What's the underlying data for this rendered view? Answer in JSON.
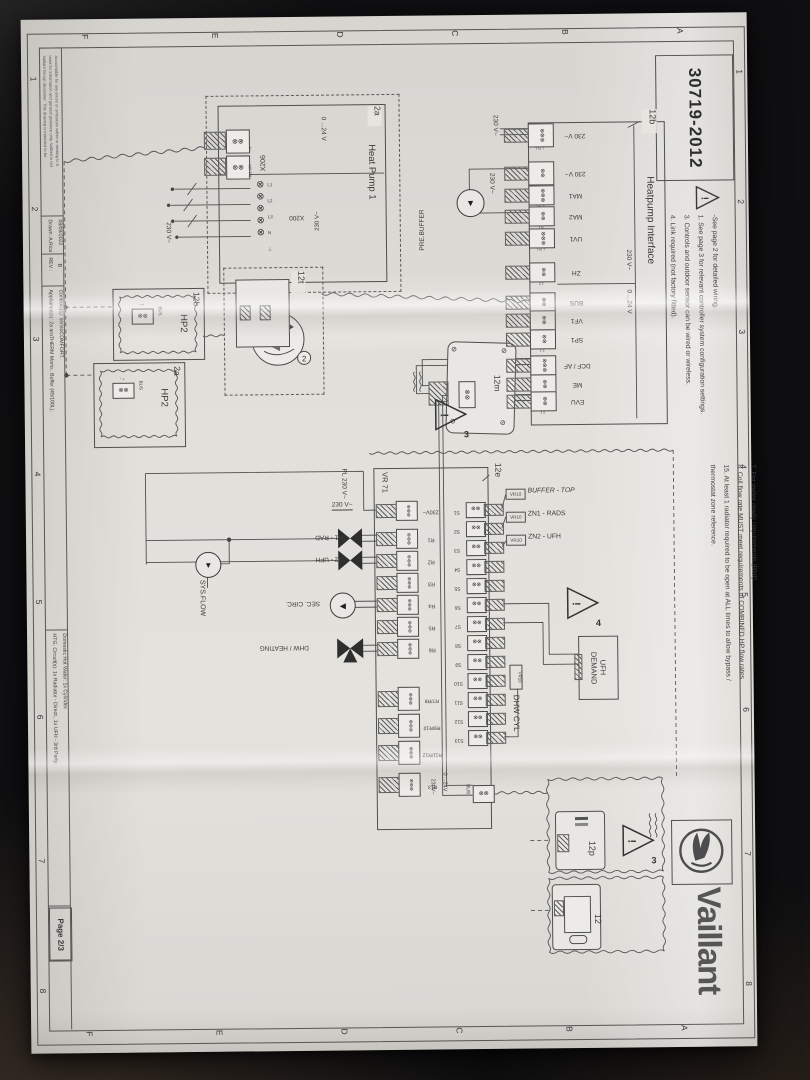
{
  "window": {
    "drawing_number": "30719-2012",
    "page": "Page 2/3",
    "brand": "Vaillant"
  },
  "zones": {
    "letters": [
      "A",
      "B",
      "C",
      "D",
      "E",
      "F"
    ],
    "numbers": [
      "1",
      "2",
      "3",
      "4",
      "5",
      "6",
      "7",
      "8"
    ]
  },
  "notes_top_left": [
    "-See page 2 for detailed wiring.",
    "1. See page 3 for relevant controller system configuration settings.",
    "3. Controls and outdoor sensor can be wired or wireless.",
    "4. Link required (not factory fitted)."
  ],
  "notes_top_right": [
    "7. For meter ready requirements (RHI).",
    "8. Coil flow rate MUST meet requirements of COMBINED HP flow rates.",
    "15. At least 1 radiator required to be open at ALL times to allow bypass /",
    "thermostat zone reference."
  ],
  "heatpump_interface": {
    "callout": "12b",
    "title": "Heatpump Interface",
    "hv_range": "230 V~",
    "lv_range": "0 ...24 V",
    "supply_labels": [
      "230 V~",
      "230 V~"
    ],
    "prebuffer": "PRE.BUFFER",
    "terminals": [
      {
        "label": "230 V~",
        "pins": "⊥ N L"
      },
      {
        "label": "230 V~",
        "pins": "N L"
      },
      {
        "label": "MA1",
        "pins": "⊥ N L"
      },
      {
        "label": "MA2",
        "pins": "N L"
      },
      {
        "label": "UV1",
        "pins": "⊥ N L"
      },
      {
        "label": "ZH",
        "pins": "1 2"
      },
      {
        "label": "BUS",
        "pins": "+ -"
      },
      {
        "label": "VF1",
        "pins": "2 1"
      },
      {
        "label": "SP1",
        "pins": "2 1"
      },
      {
        "label": "DCF / AF",
        "pins": "0 AF DCF"
      },
      {
        "label": "ME",
        "pins": "2 1"
      },
      {
        "label": "EVU",
        "pins": "2 1"
      }
    ]
  },
  "heat_pump_1": {
    "callout": "2a",
    "title": "Heat Pump 1",
    "x206_label": "X206",
    "x206_range": "0 ...24 V",
    "x206_pins": [
      "- +",
      "S21 S20"
    ],
    "x200_label": "X200",
    "x200_range": "230 V~",
    "x200_pins": [
      "L1",
      "L2",
      "L3",
      "N",
      "⊥"
    ],
    "supply": "230 V~"
  },
  "hp2_units": [
    {
      "callout": "12b",
      "name": "HP2",
      "bus": "BUS",
      "pins": "+ -"
    },
    {
      "callout": "2a",
      "name": "HP2",
      "bus": "BUS",
      "pins": "+ -"
    }
  ],
  "receiver": {
    "callout": "12t",
    "detail": "2"
  },
  "outdoor_sensor": {
    "callout": "12m",
    "warning": "3"
  },
  "vr71": {
    "name": "VR 71",
    "callout": "12e",
    "supply_label": "230V~",
    "relays": [
      "R1",
      "R2",
      "R3",
      "R4",
      "R5",
      "R6"
    ],
    "relay_pins": "⊥ N L",
    "relays2": [
      {
        "label": "R7/R8",
        "pins": "N L1 L2"
      },
      {
        "label": "R9/R10",
        "pins": "N L1 L2"
      },
      {
        "label": "R11/R12",
        "pins": "N L1 L2"
      },
      {
        "label": "R13",
        "pins": "N L"
      }
    ],
    "sensors": [
      "S1",
      "S2",
      "S3",
      "S4",
      "S5",
      "S6",
      "S7",
      "S8",
      "S9",
      "S10",
      "S11",
      "S12",
      "S13"
    ],
    "sensor_pins": "1 2",
    "feed_hv": "230V~",
    "feed_lv": "0 ...24V",
    "bus": "BUS"
  },
  "vr10_sensors": [
    {
      "tag": "VR10",
      "label": "BUFFER - TOP"
    },
    {
      "tag": "VR10",
      "label": "ZN1 - RADS"
    },
    {
      "tag": "VR10",
      "label": "ZN2 - UFH"
    }
  ],
  "dhw_sensor": {
    "tag": "VR10",
    "label": "DHW CYL"
  },
  "field": {
    "pl": "PL 230 V~",
    "feed": "230 V~",
    "zn1": "ZN1 - RAD",
    "zn2": "ZN2 - UFH",
    "sec": "SEC. CIRC.",
    "dhw": "DHW / HEATING",
    "sys": "SYS.FLOW",
    "ufh1": "UFH",
    "ufh2": "DEMAND",
    "warning": "4"
  },
  "controls": {
    "programmer": "12p",
    "room_stat": "12",
    "warning": "3"
  },
  "title_block": {
    "disclaimer": [
      "Vaillant Group disclaimer: This drawing is intended to be",
      "used for information and general guidance only. Vaillant is not",
      "accountable for any errors or omissions within or relating to it."
    ],
    "drawn": "Drawn: A.Rice",
    "date": "08/09/2022",
    "rev": "REV :",
    "rev_value": "B",
    "appliances": "Appliance(s): 2a aroTHERM Mono., Buffer (45/100L).",
    "controls": "Controls(s): sensoCOMFORT.",
    "htg": "HTG. Circuit(s): 1x Radiator - Direct., 1x UFH - 3rd Party.",
    "dhw": "Domestic Hot Water: 1x Cylinder."
  }
}
